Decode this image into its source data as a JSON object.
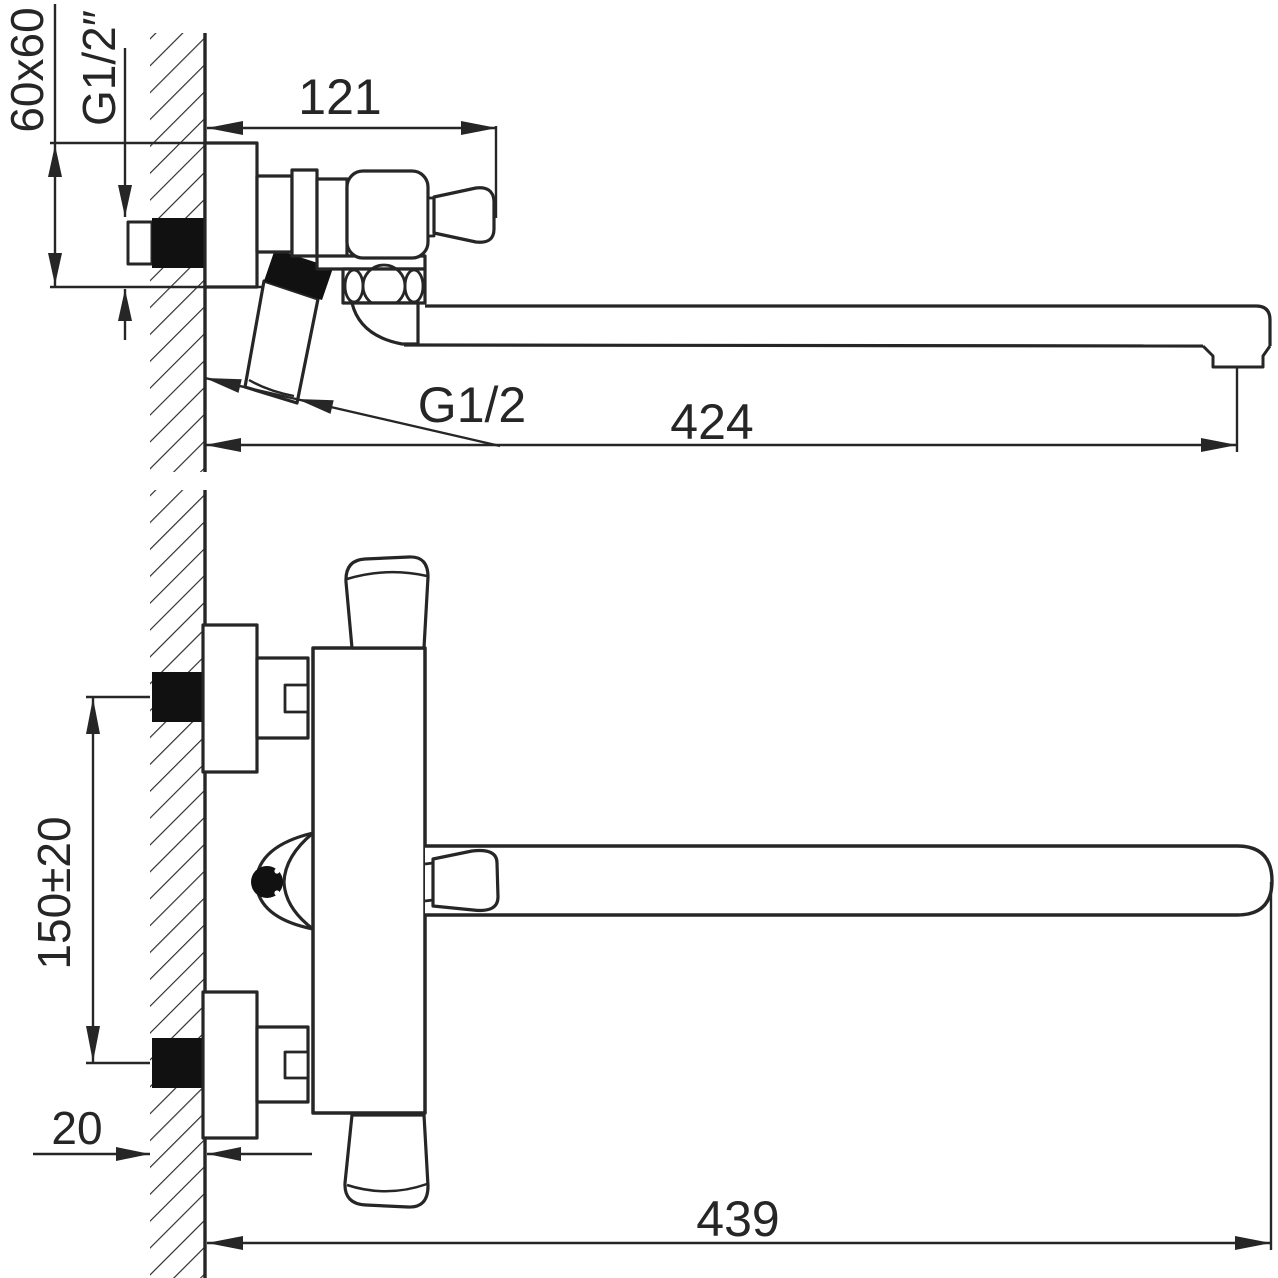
{
  "drawing": {
    "type": "technical-dimension-drawing",
    "colors": {
      "line": "#262626",
      "background": "#ffffff",
      "fitting_fill": "#111111"
    },
    "views": {
      "side": {
        "labels": {
          "plate_size": "60x60",
          "inlet_thread": "G1/2″",
          "wall_to_handle": "121",
          "shower_thread": "G1/2",
          "spout_reach": "424"
        }
      },
      "front": {
        "labels": {
          "inlet_spacing": "150±20",
          "wall_thickness": "20",
          "overall_length": "439"
        }
      }
    }
  }
}
